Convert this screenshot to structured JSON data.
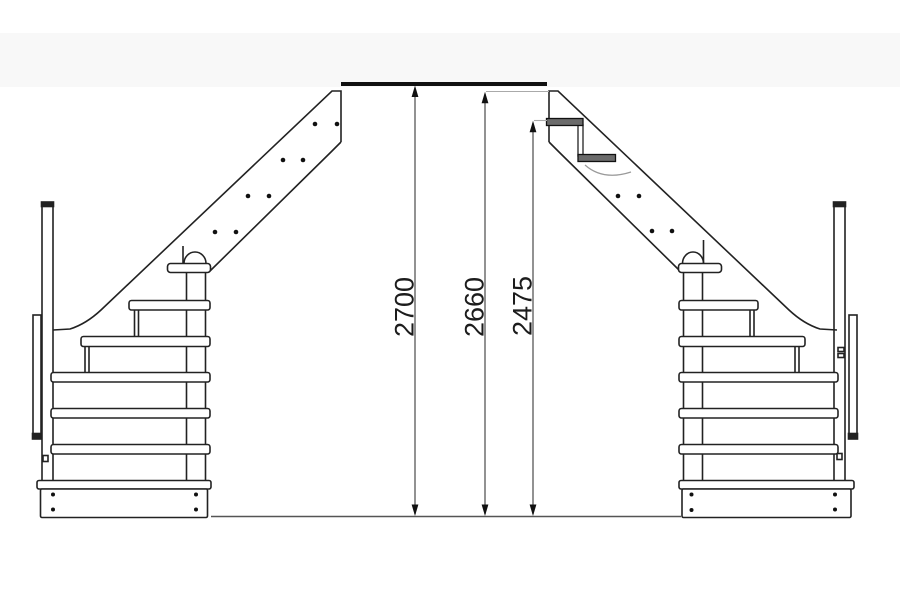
{
  "diagram": {
    "type": "staircase-elevation-technical-drawing",
    "description": "Two mirrored side views of a wooden staircase with vertical height dimensions",
    "dimensions": [
      {
        "id": "total-rise",
        "label": "2700"
      },
      {
        "id": "stringer-top-height",
        "label": "2660"
      },
      {
        "id": "first-step-height",
        "label": "2475"
      }
    ],
    "colors": {
      "background": "#ffffff",
      "ceiling_band": "#f8f8f8",
      "line": "#222222",
      "thick_floor_line": "#111111",
      "dimension_line": "#4a4a4a",
      "extension_line": "#aaaaaa",
      "ground_line": "#555555",
      "tread_hatch_fill": "#6b6b6b",
      "arrow_fill": "#111111"
    }
  }
}
